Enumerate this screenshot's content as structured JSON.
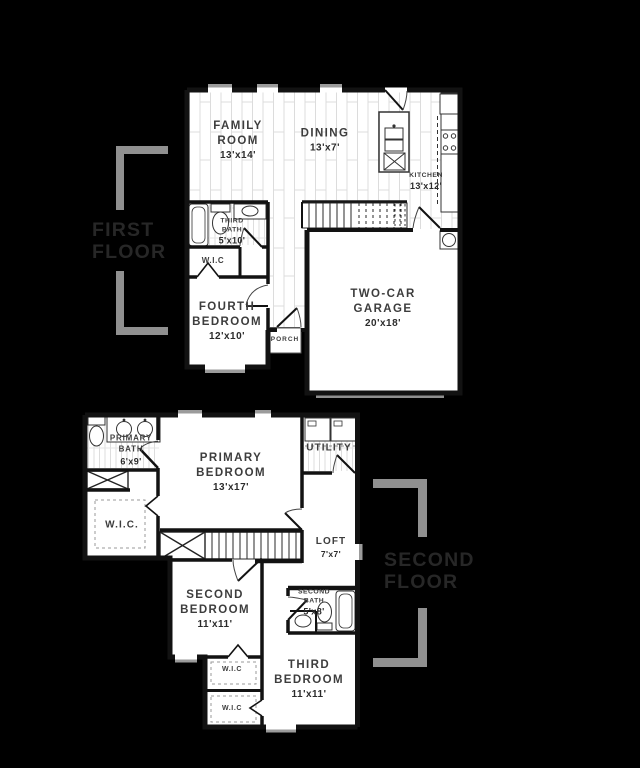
{
  "floor_plan": {
    "colors": {
      "background": "#000000",
      "wall": "#121212",
      "floor": "#ffffff",
      "plank_line": "#dcdcdc",
      "window": "#9b9b9b",
      "bracket": "#909090",
      "tag_text": "#272727",
      "label_text": "#3d3d3d"
    },
    "first_floor": {
      "tag_line1": "FIRST",
      "tag_line2": "FLOOR",
      "rooms": {
        "family_room": {
          "name": "FAMILY ROOM",
          "dims": "13'x14'"
        },
        "dining": {
          "name": "DINING",
          "dims": "13'x7'"
        },
        "kitchen": {
          "name": "KITCHEN",
          "dims": "13'x12'"
        },
        "third_bath": {
          "name": "THIRD BATH",
          "dims": "5'x10'"
        },
        "wic": {
          "name": "W.I.C"
        },
        "fourth_bedroom": {
          "name": "FOURTH BEDROOM",
          "dims": "12'x10'"
        },
        "porch": {
          "name": "PORCH"
        },
        "garage": {
          "name": "TWO-CAR GARAGE",
          "dims": "20'x18'"
        }
      }
    },
    "second_floor": {
      "tag_line1": "SECOND",
      "tag_line2": "FLOOR",
      "rooms": {
        "primary_bath": {
          "name": "PRIMARY BATH",
          "dims": "6'x9'"
        },
        "primary_bedroom": {
          "name": "PRIMARY BEDROOM",
          "dims": "13'x17'"
        },
        "utility": {
          "name": "UTILITY"
        },
        "wic": {
          "name": "W.I.C."
        },
        "loft": {
          "name": "LOFT",
          "dims": "7'x7'"
        },
        "second_bedroom": {
          "name": "SECOND BEDROOM",
          "dims": "11'x11'"
        },
        "second_bath": {
          "name": "SECOND BATH",
          "dims": "5'x8'"
        },
        "third_bedroom": {
          "name": "THIRD BEDROOM",
          "dims": "11'x11'"
        },
        "wic_second": {
          "name": "W.I.C"
        },
        "wic_third": {
          "name": "W.I.C"
        }
      }
    }
  }
}
